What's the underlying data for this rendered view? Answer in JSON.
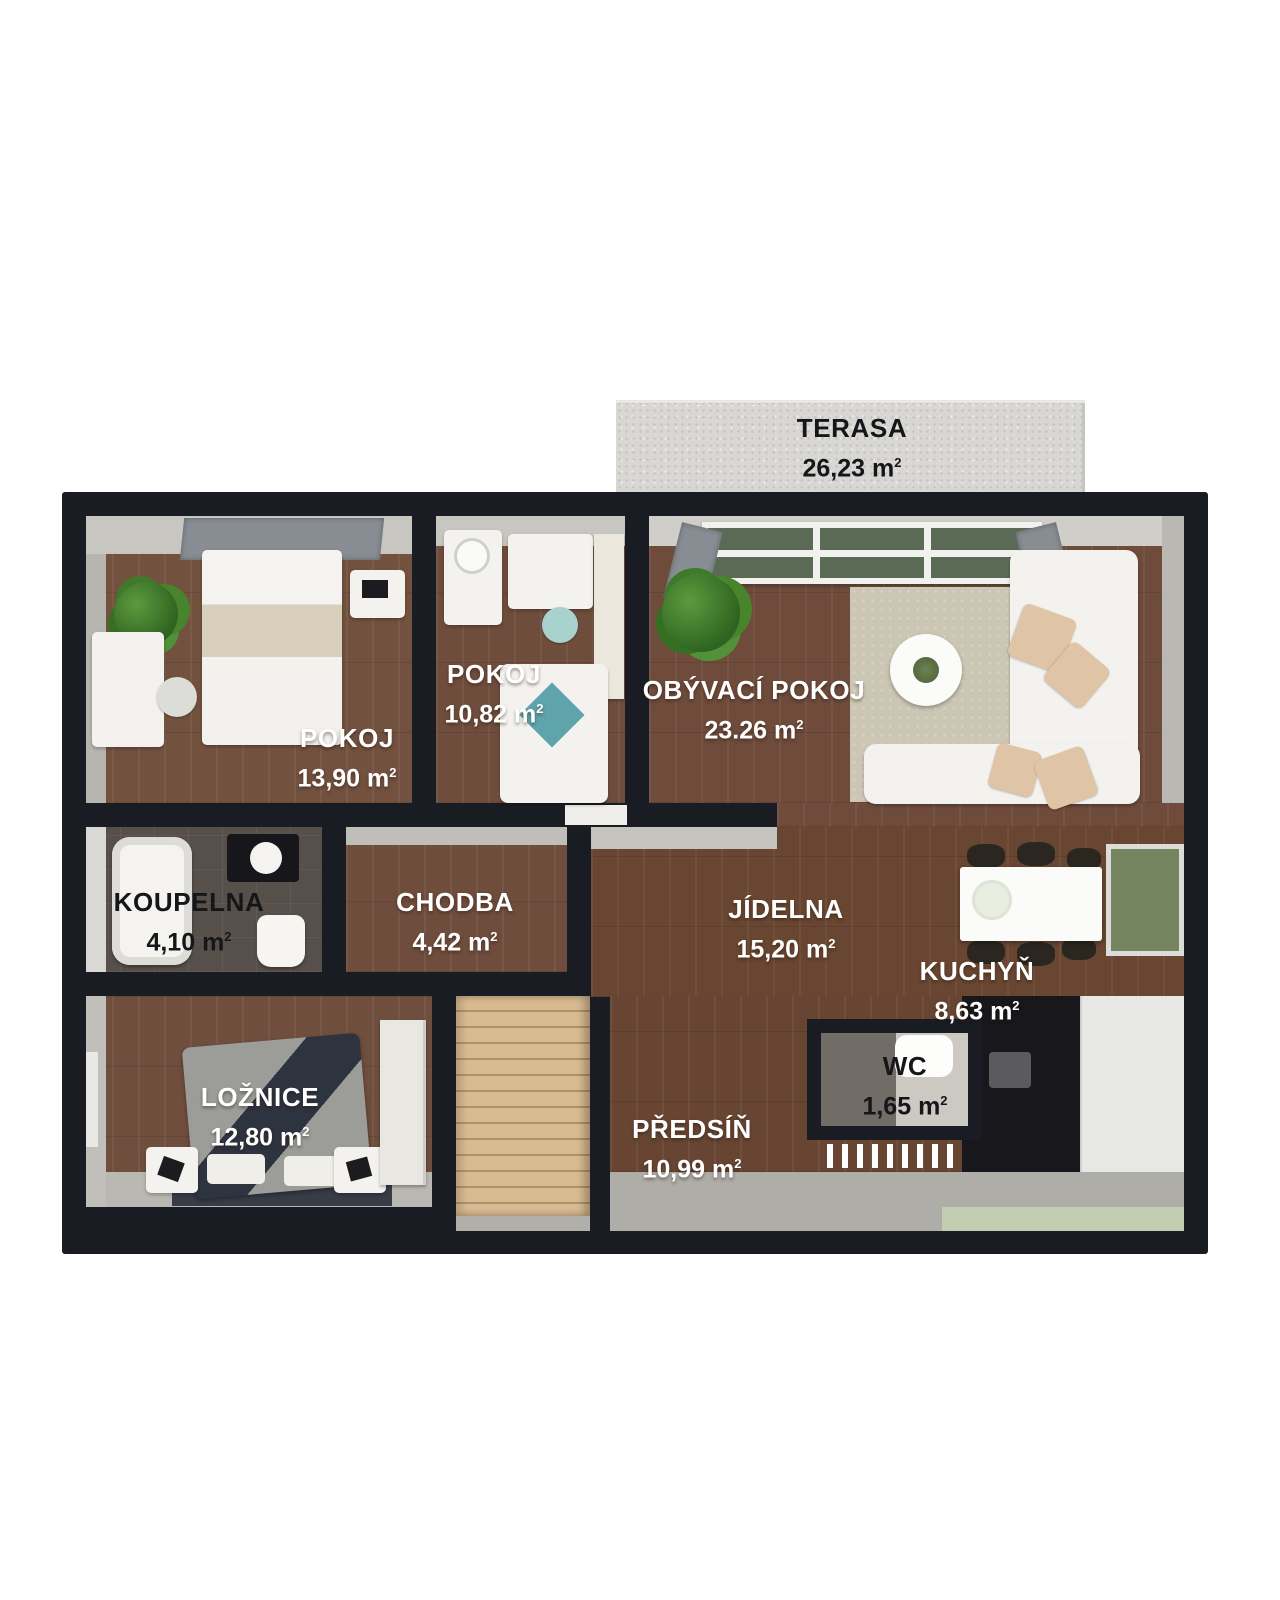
{
  "meta": {
    "type": "floor-plan-3d-top-view",
    "language": "cs",
    "superscript": "2"
  },
  "colors": {
    "wall": "#1a1c23",
    "wood_floor": "#6f4d3d",
    "wood_floor_dark": "#674532",
    "terrace": "#d9d7d3",
    "bath_tile": "#57504a",
    "wall_face_gray": "#c7c6c0",
    "rug_beige": "#ccc6b4",
    "stairs_tan": "#d9bb92",
    "green_floor": "#c2cdb2",
    "window_glass_green": "#5a6a54",
    "label_light": "#ffffff",
    "label_dark": "#15161a"
  },
  "rooms": {
    "terasa": {
      "name": "TERASA",
      "area": "26,23 m"
    },
    "pokoj1": {
      "name": "POKOJ",
      "area": "13,90 m"
    },
    "pokoj2": {
      "name": "POKOJ",
      "area": "10,82 m"
    },
    "obyvaci": {
      "name": "OBÝVACÍ POKOJ",
      "area": "23.26 m"
    },
    "koupelna": {
      "name": "KOUPELNA",
      "area": "4,10 m"
    },
    "chodba": {
      "name": "CHODBA",
      "area": "4,42 m"
    },
    "jidelna": {
      "name": "JÍDELNA",
      "area": "15,20 m"
    },
    "kuchyn": {
      "name": "KUCHYŇ",
      "area": "8,63 m"
    },
    "loznice": {
      "name": "LOŽNICE",
      "area": "12,80 m"
    },
    "predsin": {
      "name": "PŘEDSÍŇ",
      "area": "10,99 m"
    },
    "wc": {
      "name": "WC",
      "area": "1,65 m"
    }
  }
}
